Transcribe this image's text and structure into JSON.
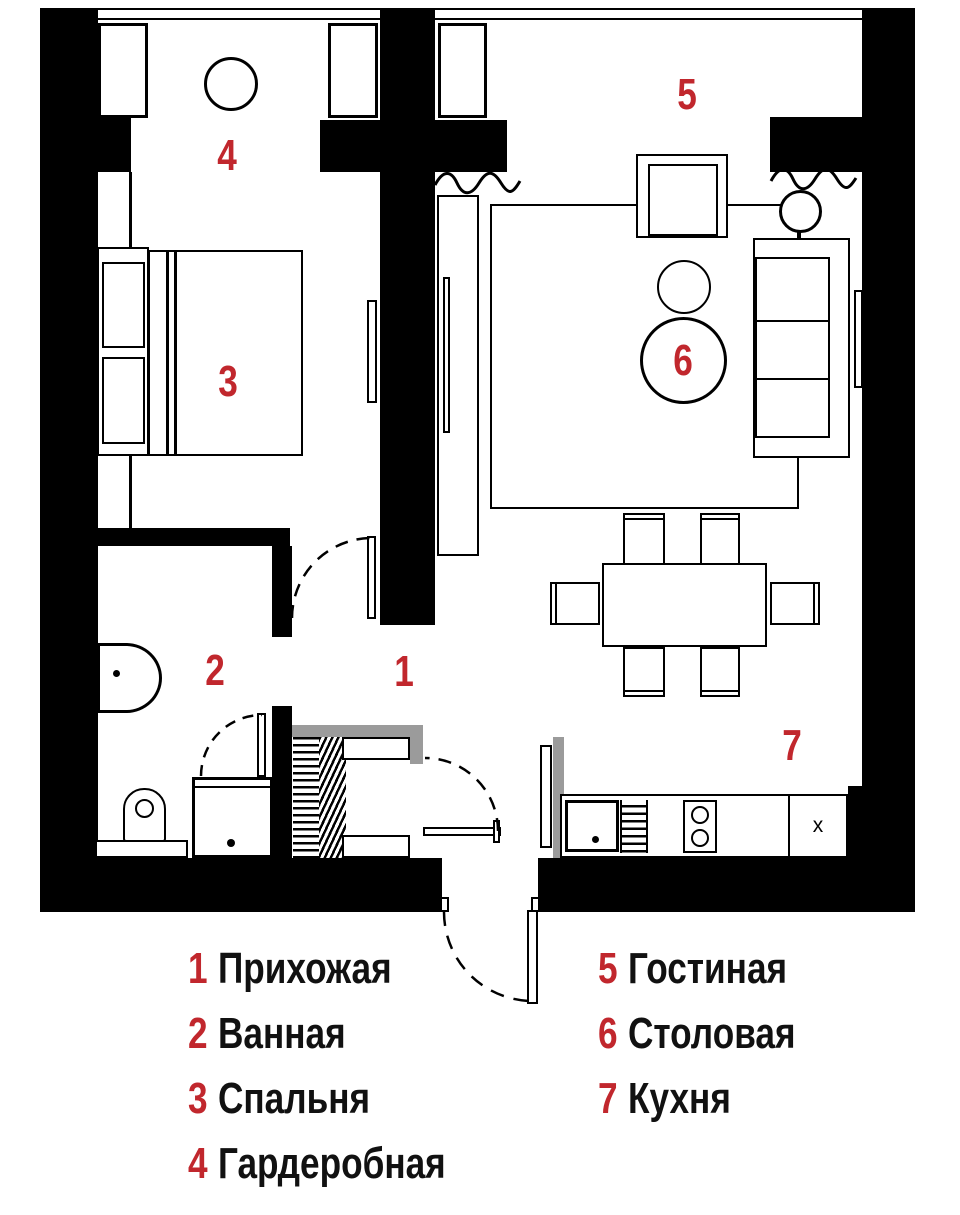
{
  "legend": {
    "left": [
      {
        "num": "1",
        "label": "Прихожая"
      },
      {
        "num": "2",
        "label": "Ванная"
      },
      {
        "num": "3",
        "label": "Спальня"
      },
      {
        "num": "4",
        "label": "Гардеробная"
      }
    ],
    "right": [
      {
        "num": "5",
        "label": "Гостиная"
      },
      {
        "num": "6",
        "label": "Столовая"
      },
      {
        "num": "7",
        "label": "Кухня"
      }
    ]
  },
  "plan": {
    "room_numbers": {
      "hallway": "1",
      "bathroom": "2",
      "bedroom": "3",
      "wardrobe": "4",
      "living": "5",
      "dining": "6",
      "kitchen": "7"
    },
    "kitchen_cabinet_mark": "x"
  },
  "colors": {
    "accent_red": "#C1272D",
    "wall": "#000000",
    "hardware_gray": "#9B9B9B"
  }
}
